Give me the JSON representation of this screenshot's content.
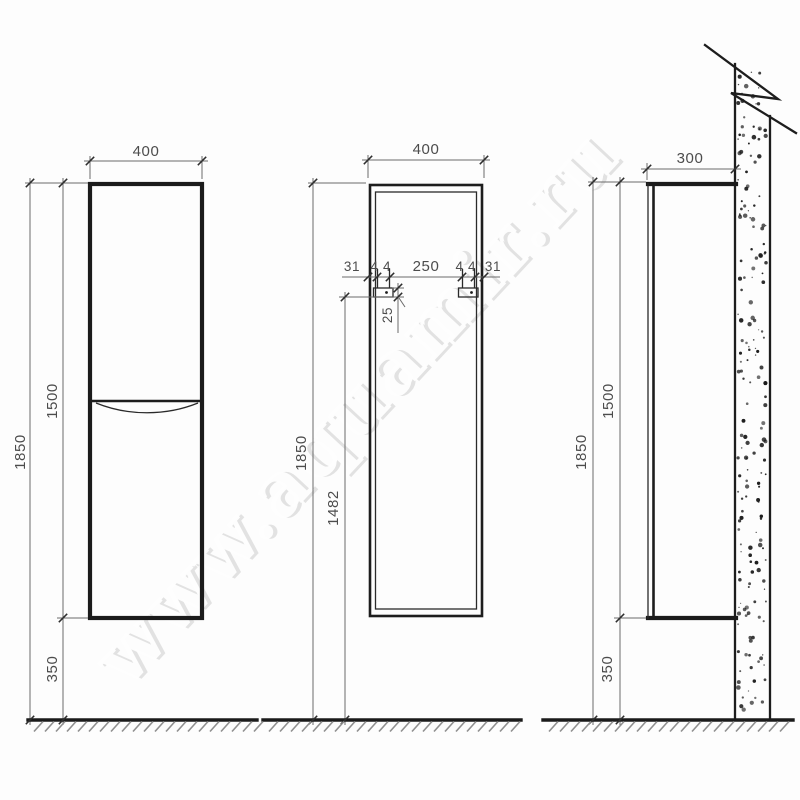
{
  "watermark": {
    "text": "www.aquamir.ru"
  },
  "front_view": {
    "width": "400",
    "height_total": "1850",
    "height_cabinet": "1500",
    "bottom_clearance": "350"
  },
  "back_view": {
    "width": "400",
    "edge_offset_left": "31",
    "bracket_width_left": "44",
    "bracket_gap": "250",
    "bracket_width_right": "44",
    "edge_offset_right": "31",
    "bracket_rail_height": "25",
    "height_total": "1850",
    "bracket_height_from_floor": "1482"
  },
  "side_view": {
    "depth": "300",
    "height_total": "1850",
    "height_cabinet": "1500",
    "bottom_clearance": "350"
  }
}
